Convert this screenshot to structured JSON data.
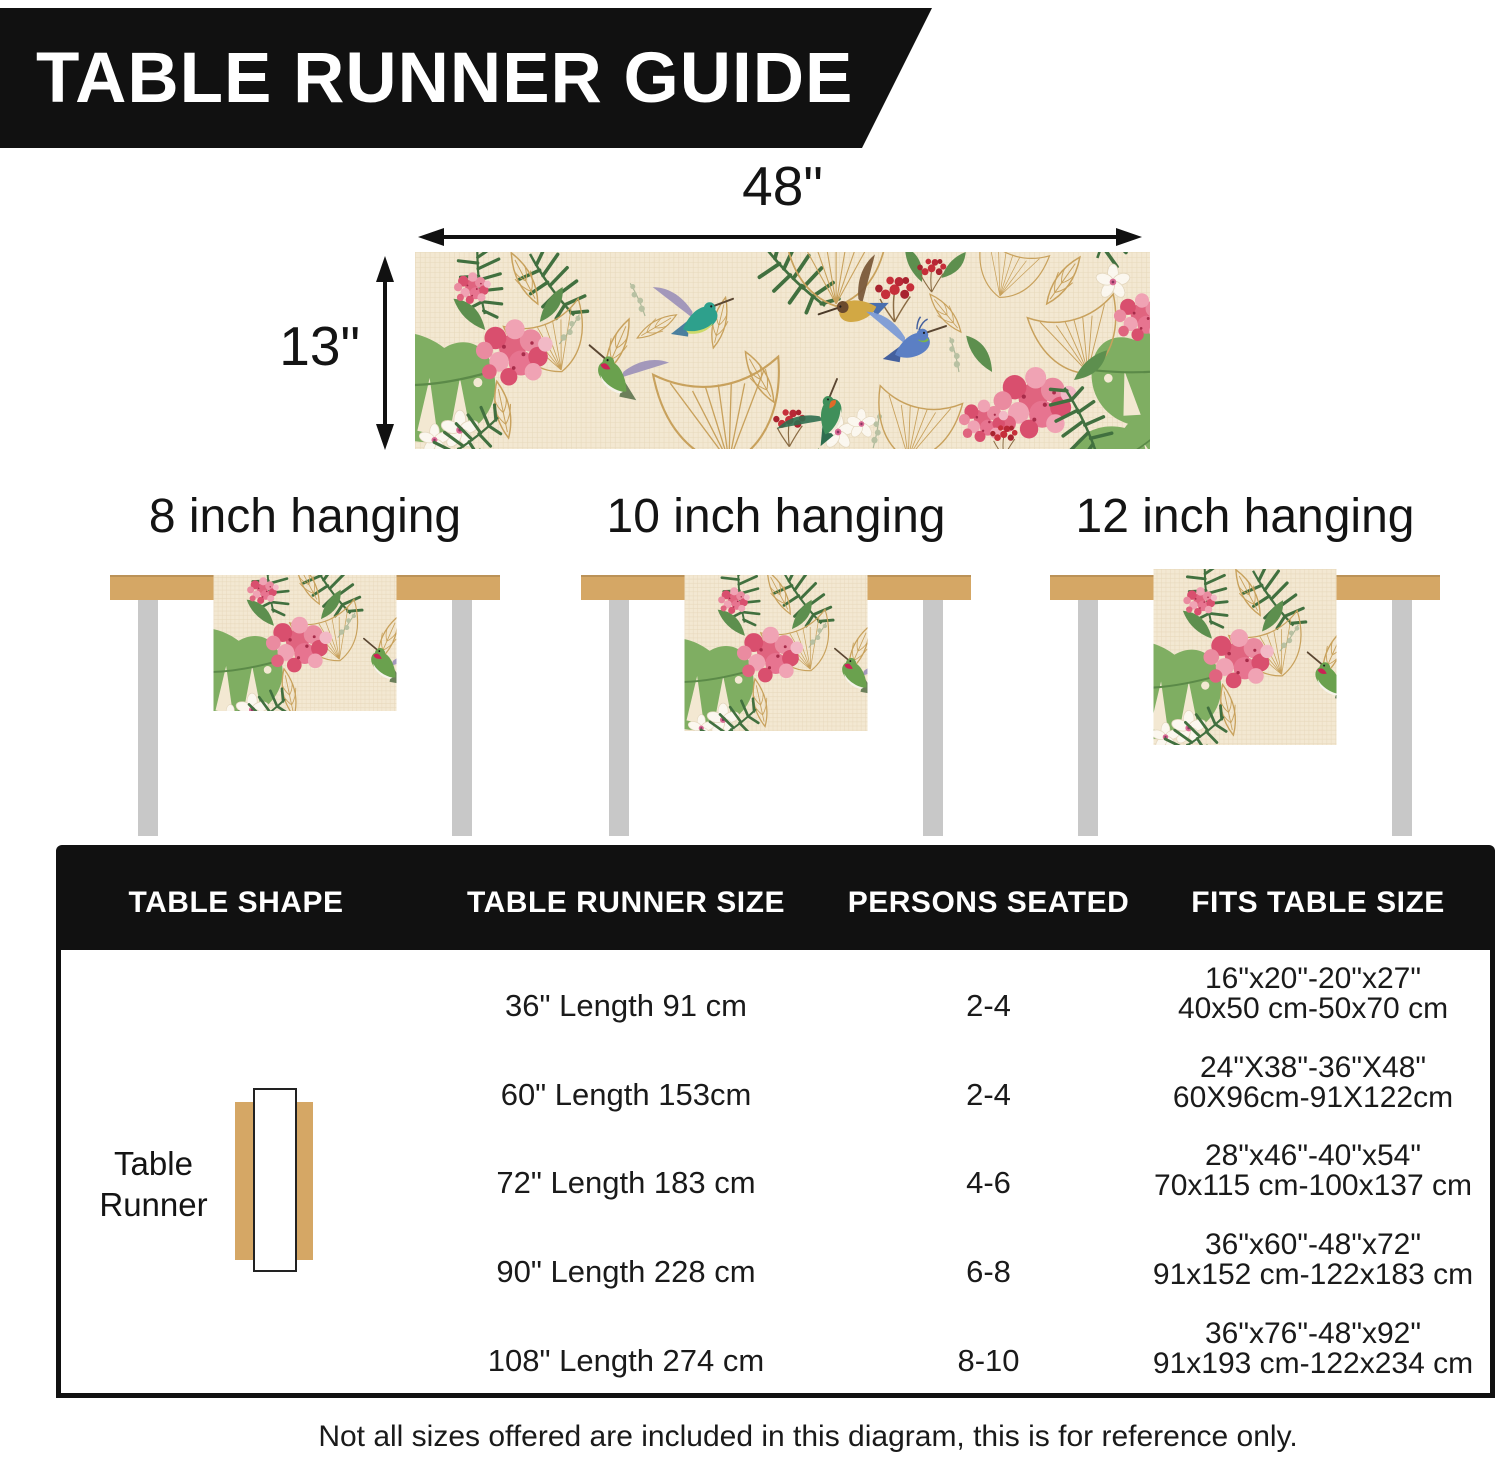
{
  "page": {
    "title": "TABLE RUNNER GUIDE"
  },
  "dimensions": {
    "width_label": "48\"",
    "height_label": "13\""
  },
  "hanging_options": [
    {
      "label": "8 inch hanging"
    },
    {
      "label": "10 inch hanging"
    },
    {
      "label": "12 inch hanging"
    }
  ],
  "size_table": {
    "headers": [
      "TABLE SHAPE",
      "TABLE RUNNER SIZE",
      "PERSONS SEATED",
      "FITS TABLE SIZE"
    ],
    "shape_label_line1": "Table",
    "shape_label_line2": "Runner",
    "rows": [
      {
        "runner_size": "36\" Length 91 cm",
        "persons": "2-4",
        "fits_line1": "16\"x20\"-20\"x27\"",
        "fits_line2": "40x50 cm-50x70 cm"
      },
      {
        "runner_size": "60\" Length 153cm",
        "persons": "2-4",
        "fits_line1": "24\"X38\"-36\"X48\"",
        "fits_line2": "60X96cm-91X122cm"
      },
      {
        "runner_size": "72\" Length 183 cm",
        "persons": "4-6",
        "fits_line1": "28\"x46\"-40\"x54\"",
        "fits_line2": "70x115 cm-100x137 cm"
      },
      {
        "runner_size": "90\" Length 228 cm",
        "persons": "6-8",
        "fits_line1": "36\"x60\"-48\"x72\"",
        "fits_line2": "91x152 cm-122x183 cm"
      },
      {
        "runner_size": "108\" Length 274 cm",
        "persons": "8-10",
        "fits_line1": "36\"x76\"-48\"x92\"",
        "fits_line2": "91x193 cm-122x234 cm"
      }
    ]
  },
  "footer_note": "Not all sizes offered are included in this diagram, this is for reference only.",
  "colors": {
    "banner_bg": "#111111",
    "table_top": "#d5a765",
    "table_leg": "#c8c8c8",
    "runner_bg": "#f3e8d2",
    "accent_pink": "#e0647f",
    "accent_green": "#5d8f4e",
    "accent_gold": "#c8a15c"
  }
}
